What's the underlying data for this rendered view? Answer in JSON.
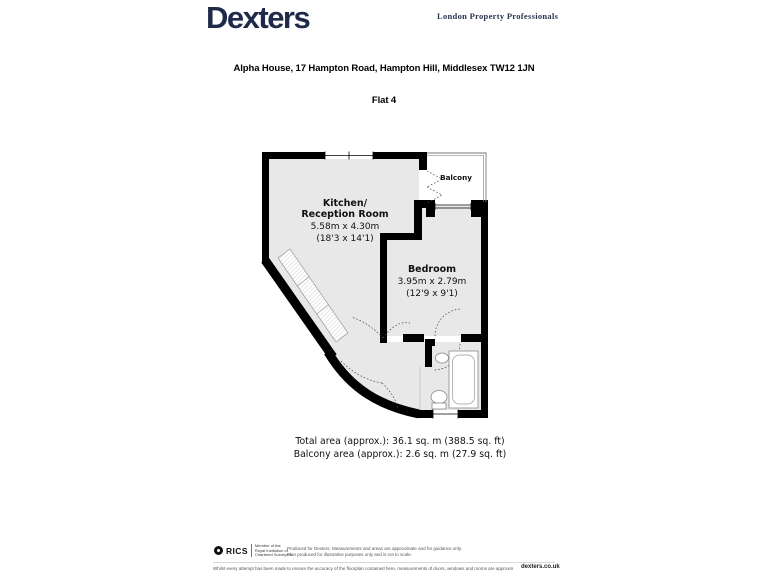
{
  "header": {
    "brand": "Dexters",
    "tagline": "London Property Professionals"
  },
  "title": {
    "address": "Alpha House, 17 Hampton Road, Hampton Hill, Middlesex TW12 1JN",
    "unit": "Flat 4"
  },
  "floorplan": {
    "kitchen": {
      "name_line1": "Kitchen/",
      "name_line2": "Reception Room",
      "size_metric": "5.58m x 4.30m",
      "size_imperial": "(18'3 x 14'1)"
    },
    "bedroom": {
      "name": "Bedroom",
      "size_metric": "3.95m x 2.79m",
      "size_imperial": "(12'9 x 9'1)"
    },
    "balcony": {
      "name": "Balcony"
    }
  },
  "areas": {
    "total": "Total area (approx.): 36.1 sq. m (388.5 sq. ft)",
    "balcony": "Balcony area (approx.): 2.6 sq. m (27.9 sq. ft)"
  },
  "footer": {
    "rics_word": "RICS",
    "rics_lines": [
      "Member of the",
      "Royal Institution of",
      "Chartered Surveyors"
    ],
    "note_line1": "Produced for Dexters. Measurements and areas are approximate and for guidance only.",
    "note_line2": "Plan produced for illustrative purposes only and is not to scale.",
    "disclaimer": "Whilst every attempt has been made to ensure the accuracy of the floorplan contained here, measurements of doors, windows and rooms are approximate and no responsibility is taken for any error, omission or mis-statement.",
    "website": "dexters.co.uk"
  },
  "colors": {
    "brand_navy": "#1f2a4a",
    "floor_fill": "#e8e8e8",
    "wall": "#000000"
  }
}
